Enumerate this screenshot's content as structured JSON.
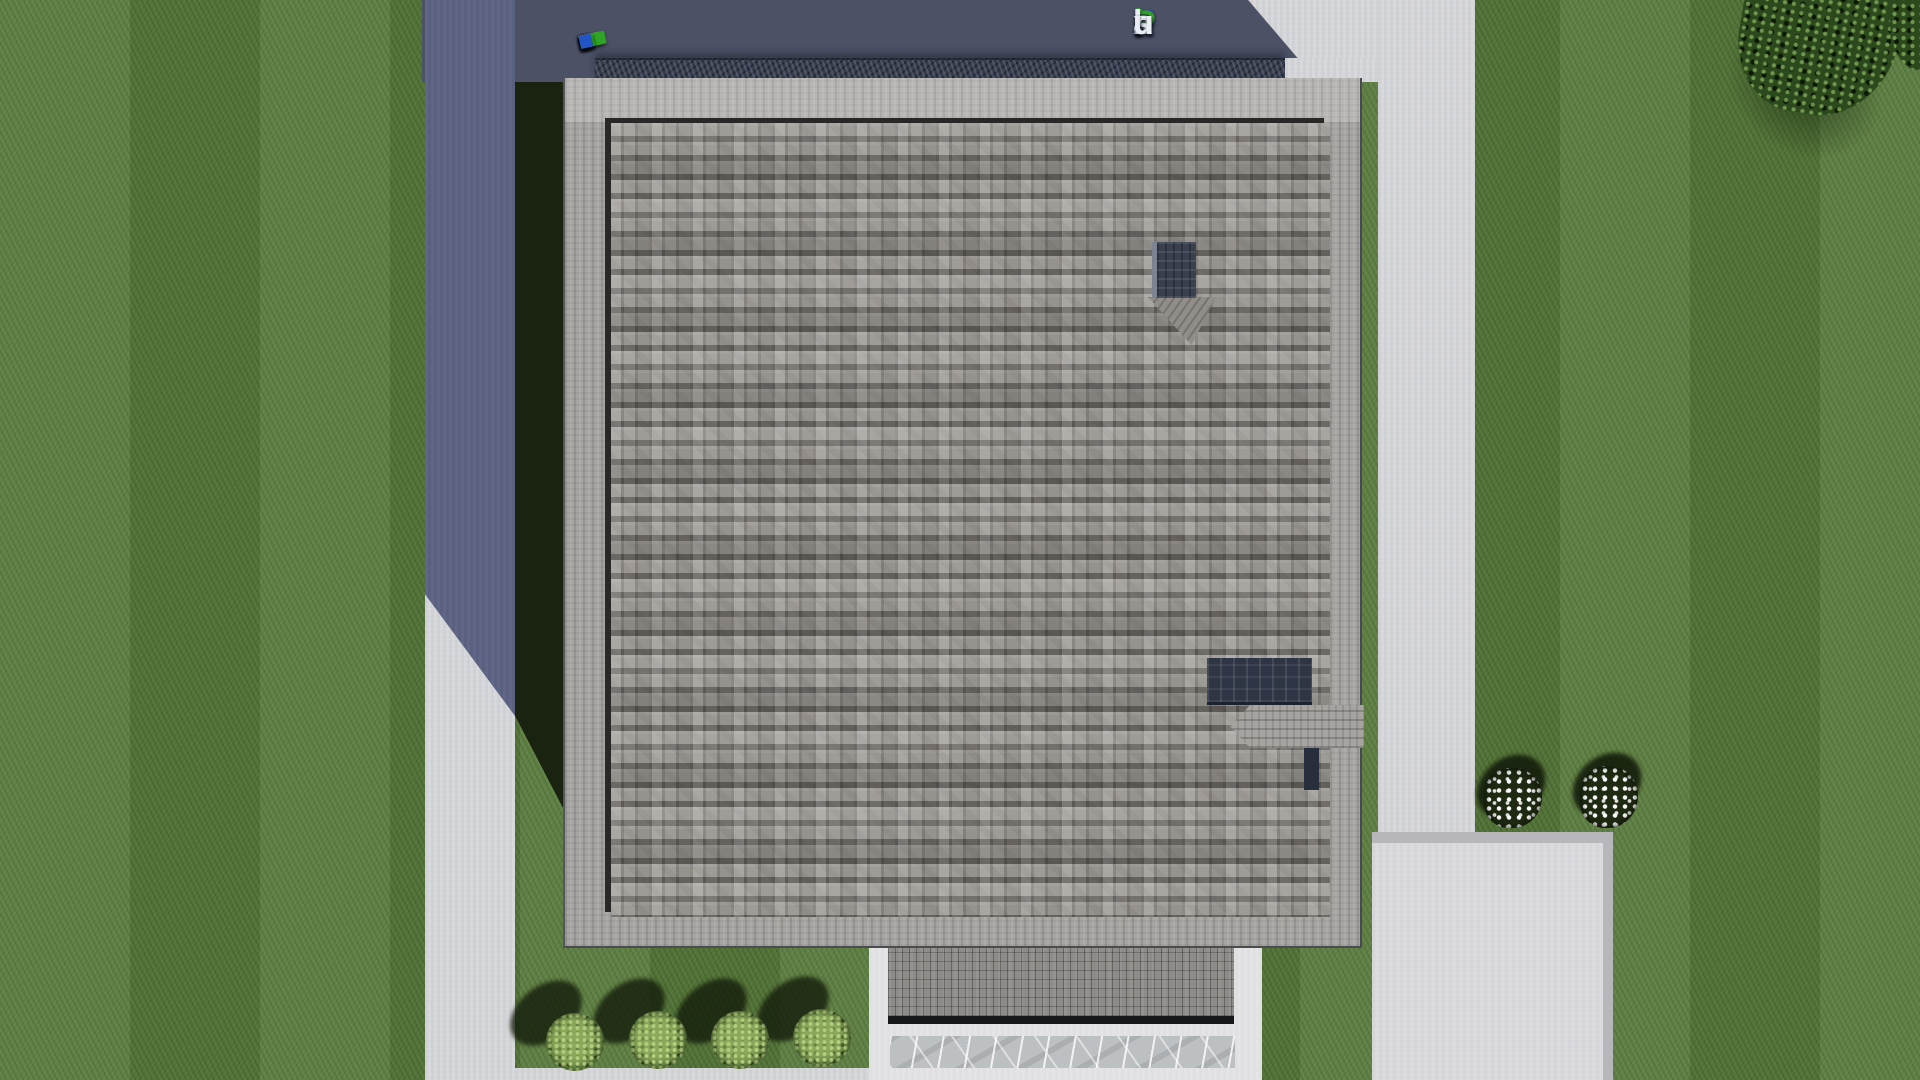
{
  "brand": {
    "text": "FixPlans.ru",
    "letters": [
      {
        "ch": "F",
        "color": "#1b53c9"
      },
      {
        "ch": "i",
        "color": "#eaedf3",
        "dot": "#2fae28"
      },
      {
        "ch": "x",
        "color": "#eaedf3"
      },
      {
        "ch": "P",
        "color": "#2fa02a"
      },
      {
        "ch": "l",
        "color": "#eaedf3"
      },
      {
        "ch": "a",
        "color": "#eaedf3"
      },
      {
        "ch": "n",
        "color": "#eaedf3"
      },
      {
        "ch": "s",
        "color": "#eaedf3"
      },
      {
        "ch": ".",
        "color": "#1b53c9"
      },
      {
        "ch": "r",
        "color": "#eaedf3"
      },
      {
        "ch": "u",
        "color": "#eaedf3"
      }
    ]
  },
  "watermark_strip": {
    "tabs": [
      {
        "w": 13,
        "color": "#f3f3f7"
      },
      {
        "w": 9,
        "color": "#e7e7ee"
      },
      {
        "w": 11,
        "color": "#ffffff"
      },
      {
        "w": 11,
        "color": "#2254c6"
      },
      {
        "w": 12,
        "color": "#e9e9f0"
      },
      {
        "w": 9,
        "color": "#ffffff"
      },
      {
        "w": 13,
        "color": "#f1f1f6"
      },
      {
        "w": 8,
        "color": "#e4e4ec"
      },
      {
        "w": 22,
        "color": "#fbfbfd"
      },
      {
        "w": 7,
        "color": "#ececf2"
      },
      {
        "w": 26,
        "color": "#2fa325"
      },
      {
        "w": 12,
        "color": "#f5f5f9"
      },
      {
        "w": 12,
        "color": "#e8e8ef"
      },
      {
        "w": 14,
        "color": "#2fa325"
      },
      {
        "w": 12,
        "color": "#2254c6"
      }
    ]
  },
  "scene": {
    "objects": [
      "lawn",
      "left-walkway",
      "top-walkway",
      "right-walkway",
      "driveway-pad",
      "bottom-walkway",
      "hedge",
      "main-roof",
      "roof-border",
      "chimney",
      "chimney-cricket",
      "roof-skylight",
      "roof-dormer",
      "entrance-porch",
      "porch-pavers",
      "stone-walkway",
      "bush",
      "bush",
      "bush",
      "bush",
      "flower-bed",
      "flower-bed",
      "tree-canopy",
      "house-shadow",
      "watermark-strip",
      "fixplans-watermark"
    ]
  },
  "palette": {
    "grass": "#587a3b",
    "grass_shadow": "#1a2310",
    "concrete": "#d6d7da",
    "concrete_shadow": "#596080",
    "strip_shadow": "#4c5166",
    "hedge": "#353c4a",
    "roof_band": "#a7a5a2",
    "roof_field": "#9a9692",
    "roof_frame": "#2a2826",
    "chimney": "#39404f",
    "skylight": "#2e3545",
    "porch": "#e4e4e6",
    "pavers": "#8d8c89",
    "marble": "#bdc0c2",
    "bush": "#6d8c48",
    "tree": "#2c491d",
    "apron": "#dadade"
  }
}
